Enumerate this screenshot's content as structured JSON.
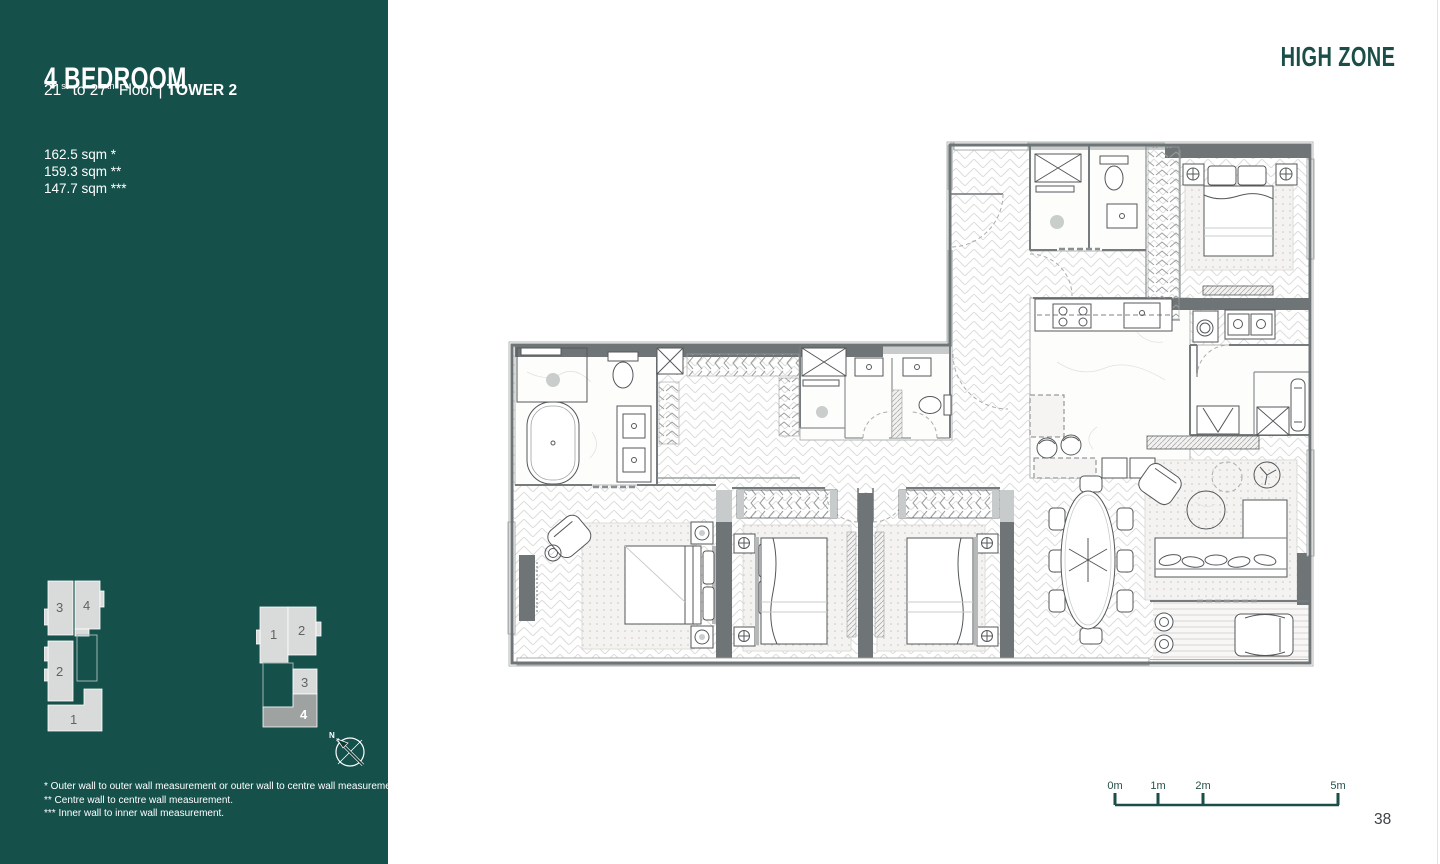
{
  "sidebar": {
    "title": "4 BEDROOM",
    "subtitle": {
      "p1": "21",
      "sup1": "st",
      "p2": " to 27",
      "sup2": "th",
      "p3": " Floor | ",
      "tower": "TOWER 2"
    },
    "areas": [
      "162.5 sqm *",
      "159.3 sqm **",
      "147.7 sqm ***"
    ],
    "footnotes": [
      "* Outer wall to outer wall measurement or outer wall to centre wall measurement.",
      "** Centre wall to centre wall measurement.",
      "*** Inner wall to inner wall measurement."
    ],
    "keyplan_tower1": {
      "units": {
        "u1": "1",
        "u2": "2",
        "u3": "3",
        "u4": "4"
      }
    },
    "keyplan_tower2": {
      "units": {
        "u1": "1",
        "u2": "2",
        "u3": "3",
        "u4": "4"
      },
      "selected_unit": "4"
    },
    "compass": "N"
  },
  "main": {
    "zone_label": "HIGH ZONE",
    "page_number": "38",
    "scalebar": {
      "ticks": [
        "0m",
        "1m",
        "2m",
        "5m"
      ]
    }
  },
  "colors": {
    "sidebar_teal": "#15504B",
    "accent_teal": "#1A4E47",
    "wall_dark": "#6F7477",
    "keyplan_unit": "#D9DBDA",
    "keyplan_selected": "#9EA3A1"
  }
}
